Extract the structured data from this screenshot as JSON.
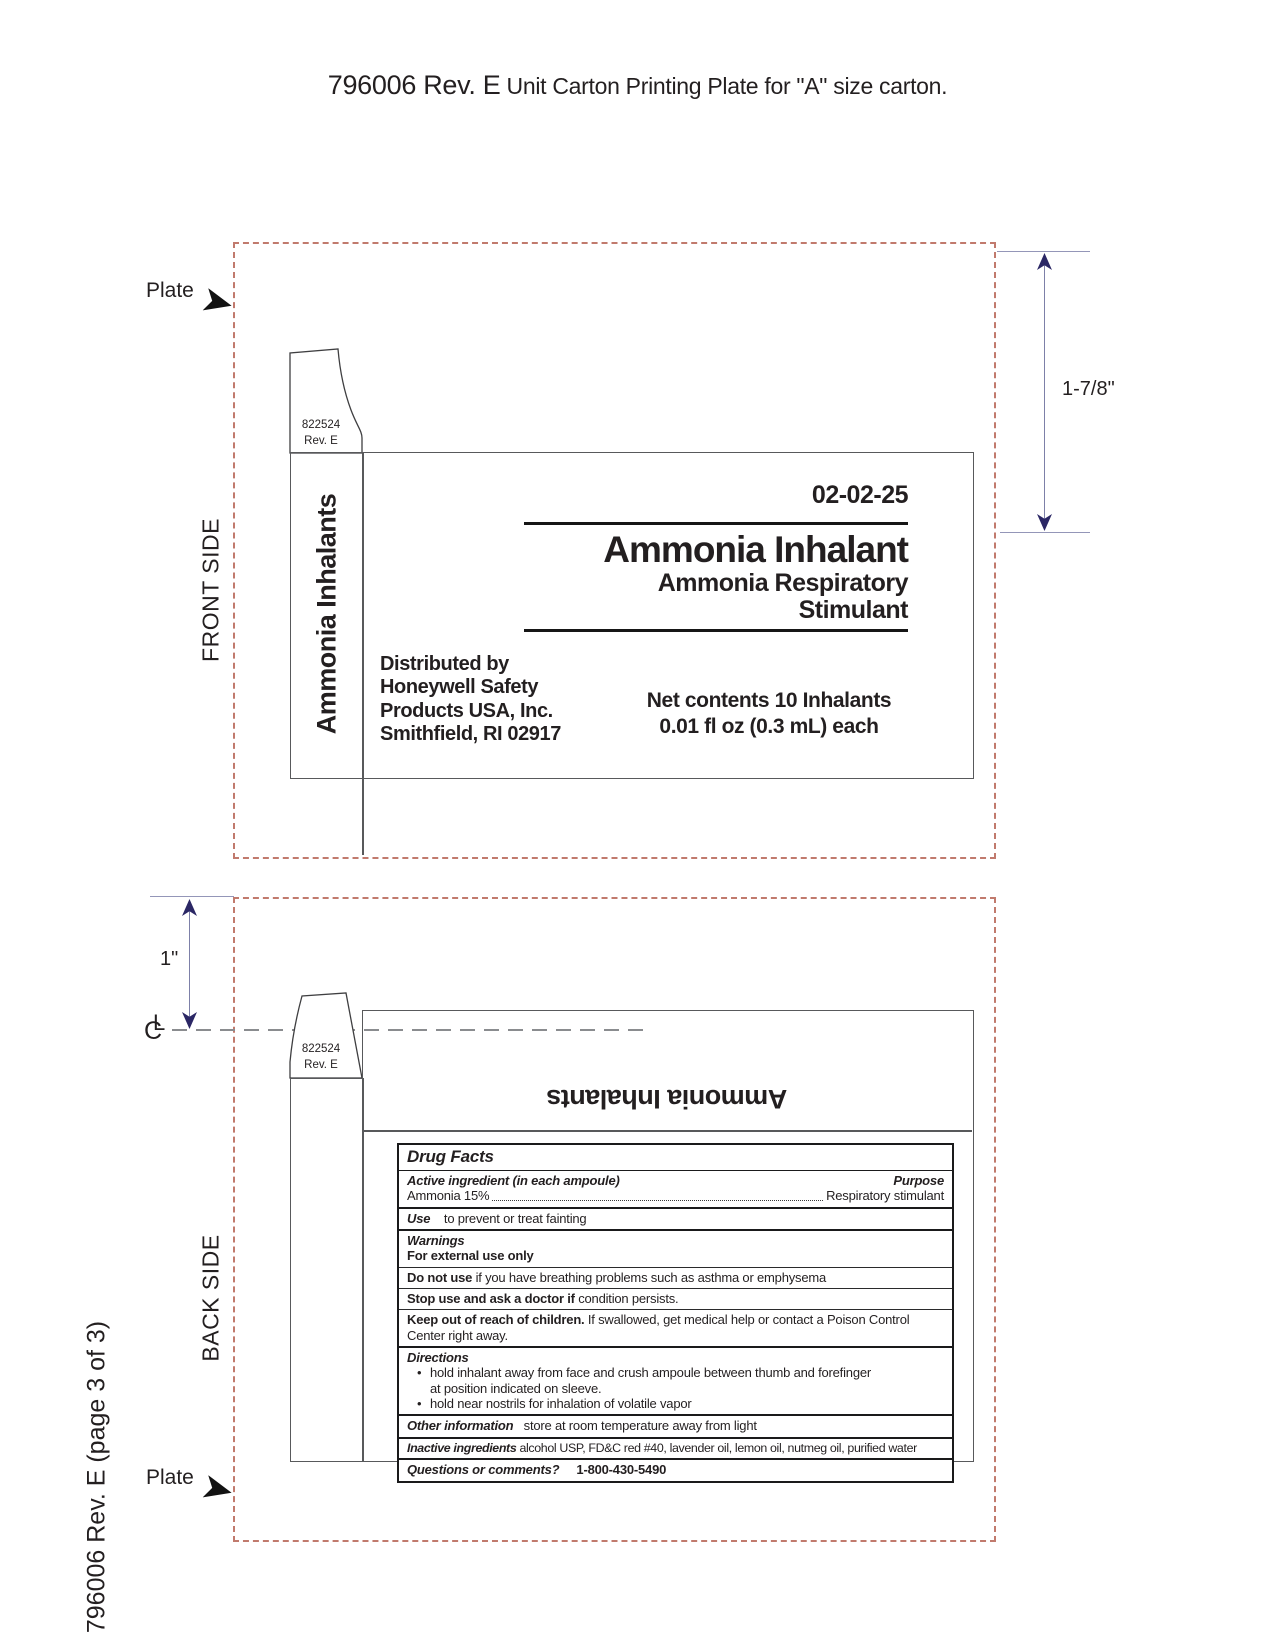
{
  "header": {
    "doc_number": "796006 Rev. E",
    "title_rest": " Unit Carton Printing Plate for \"A\" size carton."
  },
  "annotations": {
    "plate_front": "Plate",
    "plate_back": "Plate",
    "front_side": "FRONT SIDE",
    "back_side": "BACK SIDE",
    "dim_front": "1-7/8\"",
    "dim_back": "1\"",
    "centerline_c": "C",
    "centerline_l": "L",
    "footer": "796006 Rev. E (page 3 of 3)"
  },
  "carton": {
    "tab_number": "822524",
    "tab_rev": "Rev. E",
    "side_panel_title": "Ammonia Inhalants",
    "front": {
      "date": "02-02-25",
      "title": "Ammonia Inhalant",
      "subtitle1": "Ammonia Respiratory",
      "subtitle2": "Stimulant",
      "distributor": [
        "Distributed by",
        "Honeywell Safety",
        "Products USA, Inc.",
        "Smithfield, RI 02917"
      ],
      "net_contents1": "Net contents 10 Inhalants",
      "net_contents2": "0.01 fl oz (0.3 mL) each"
    },
    "back": {
      "panel_title": "Ammonia Inhalants",
      "drug_facts": {
        "title": "Drug Facts",
        "active_heading": "Active ingredient (in each ampoule)",
        "purpose_heading": "Purpose",
        "active_name": "Ammonia 15%",
        "purpose_value": "Respiratory stimulant",
        "use_label": "Use",
        "use_text": "to prevent or treat fainting",
        "warnings_label": "Warnings",
        "external_use": "For external use only",
        "do_not_use_bold": "Do not use",
        "do_not_use_text": "if you have breathing problems such as asthma or emphysema",
        "stop_use_bold": "Stop use and ask a doctor if",
        "stop_use_text": "condition persists.",
        "keep_bold": "Keep out of reach of children.",
        "keep_text": "If swallowed, get medical help or contact a Poison Control Center right away.",
        "directions_label": "Directions",
        "bullet": "•",
        "direction_1": "hold inhalant away from face and crush ampoule between thumb and forefinger",
        "direction_1_cont": "at position indicated on sleeve.",
        "direction_2": "hold near nostrils for inhalation of volatile vapor",
        "other_label": "Other information",
        "other_text": "store at room temperature away from light",
        "inactive_label": "Inactive ingredients",
        "inactive_text": "alcohol USP, FD&C red #40, lavender oil, lemon oil, nutmeg oil, purified water",
        "questions_label": "Questions or comments?",
        "questions_value": "1-800-430-5490"
      }
    }
  },
  "colors": {
    "plate": "#C17A6D",
    "navy": "#2B2765",
    "gline": "#58595B",
    "cline": "#8A8C8F",
    "ink": "#231F20"
  }
}
